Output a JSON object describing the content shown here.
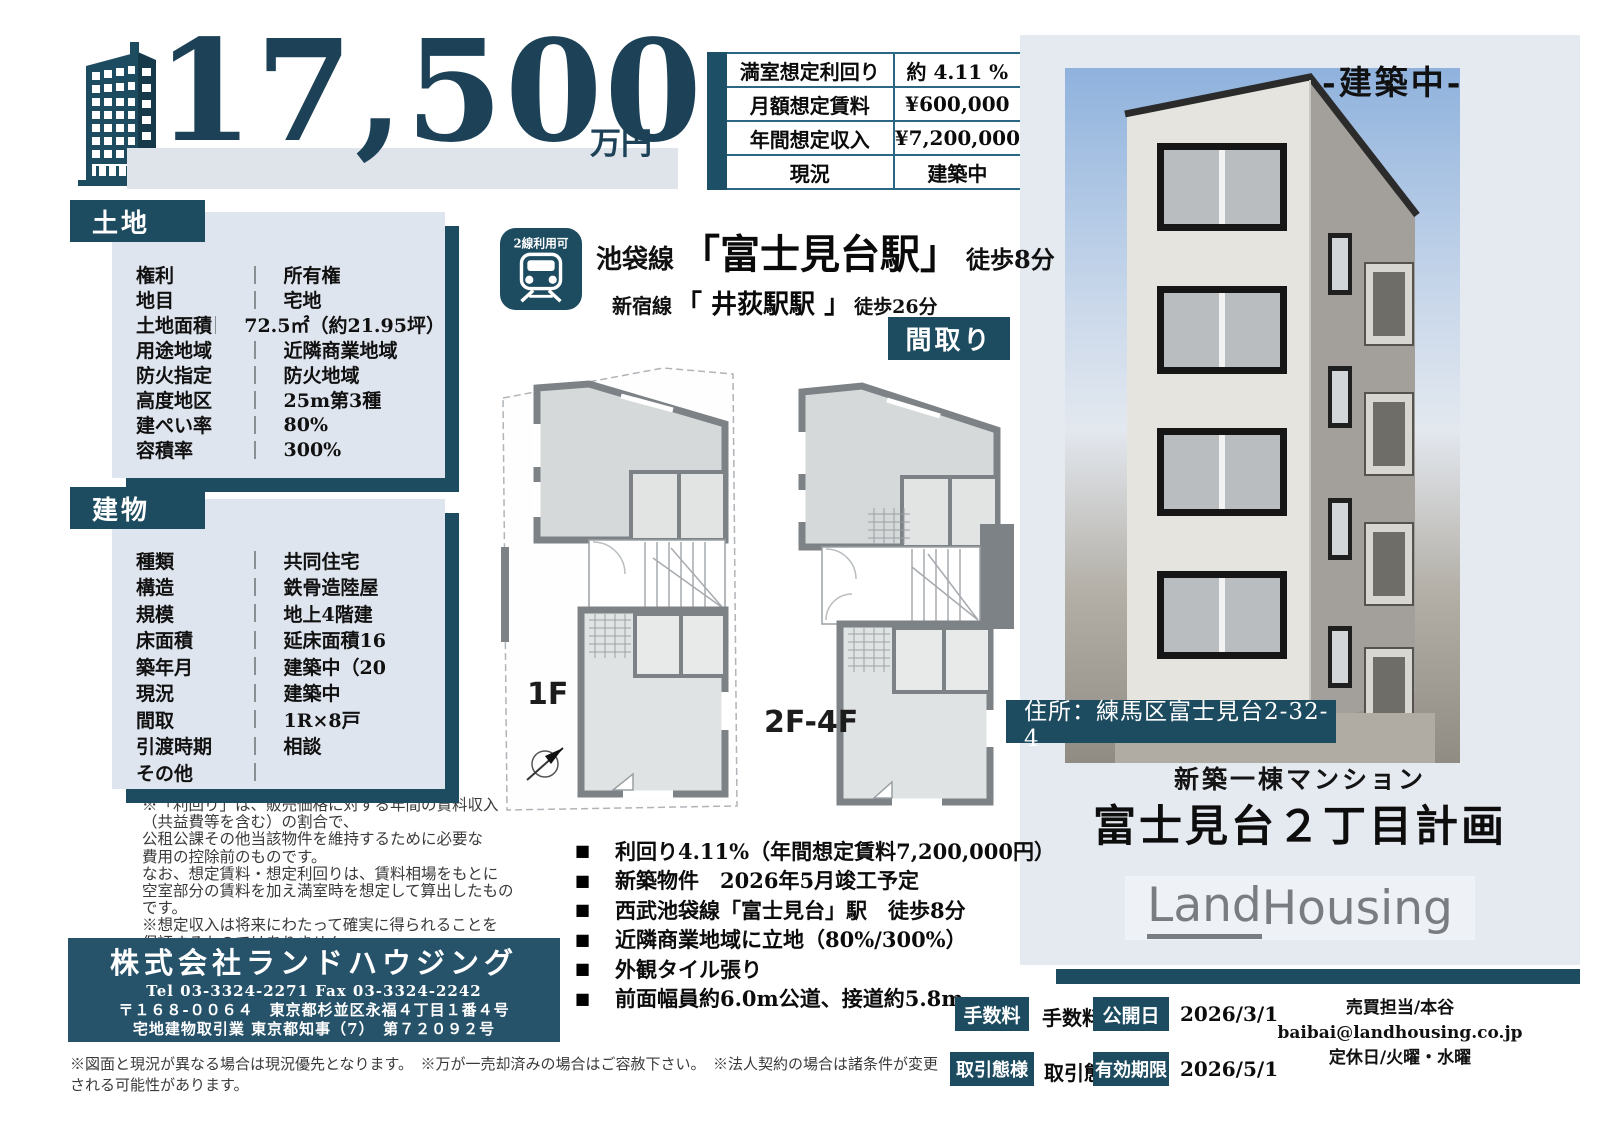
{
  "colors": {
    "teal": "#1d4b60",
    "teal_dark": "#16394a",
    "panel_blue": "#dfe5ee",
    "right_panel": "#e5e9f0",
    "price_text": "#1d4258"
  },
  "price": {
    "value": "17,500",
    "unit": "万円"
  },
  "summary": {
    "rows": [
      {
        "label": "満室想定利回り",
        "value": "約 4.11 %"
      },
      {
        "label": "月額想定賃料",
        "value": "¥600,000"
      },
      {
        "label": "年間想定収入",
        "value": "¥7,200,000"
      },
      {
        "label": "現況",
        "value": "建築中"
      }
    ]
  },
  "status_banner": "-建築中-",
  "access": {
    "badge": "2線利用可",
    "primary": {
      "line": "池袋線",
      "station": "「富士見台駅」",
      "walk": "徒歩8分"
    },
    "secondary": {
      "line": "新宿線",
      "station": "「 井荻駅駅 」",
      "walk": "徒歩26分"
    }
  },
  "floorplan": {
    "section_label": "間取り",
    "plan1": "1F",
    "plan2": "2F-4F"
  },
  "land": {
    "title": "土地",
    "rows": [
      {
        "label": "権利",
        "value": "所有権"
      },
      {
        "label": "地目",
        "value": "宅地"
      },
      {
        "label": "土地面積",
        "value": "72.5㎡（約21.95坪）"
      },
      {
        "label": "用途地域",
        "value": "近隣商業地域"
      },
      {
        "label": "防火指定",
        "value": "防火地域"
      },
      {
        "label": "高度地区",
        "value": "25m第3種"
      },
      {
        "label": "建ぺい率",
        "value": "80%"
      },
      {
        "label": "容積率",
        "value": "300%"
      }
    ]
  },
  "building": {
    "title": "建物",
    "rows": [
      {
        "label": "種類",
        "value": "共同住宅"
      },
      {
        "label": "構造",
        "value": "鉄骨造陸屋"
      },
      {
        "label": "規模",
        "value": "地上4階建"
      },
      {
        "label": "床面積",
        "value": "延床面積16"
      },
      {
        "label": "築年月",
        "value": "建築中（20"
      },
      {
        "label": "現況",
        "value": "建築中"
      },
      {
        "label": "間取",
        "value": "1R×8戸"
      },
      {
        "label": "引渡時期",
        "value": "相談"
      },
      {
        "label": "その他",
        "value": ""
      }
    ]
  },
  "disclaimer": {
    "lines": [
      "※「利回り」は、販売価格に対する年間の賃料収入",
      "（共益費等を含む）の割合で、",
      "公租公課その他当該物件を維持するために必要な",
      "費用の控除前のものです。",
      "なお、想定賃料・想定利回りは、賃料相場をもとに",
      "空室部分の賃料を加え満室時を想定して算出したものです。",
      "※想定収入は将来にわたって確実に得られることを",
      "保証するものではありません。"
    ]
  },
  "company": {
    "name": "株式会社ランドハウジング",
    "telfax": "Tel 03-3324-2271  Fax 03-3324-2242",
    "address": "〒１６８-００６４　東京都杉並区永福４丁目１番４号",
    "license": "宅地建物取引業 東京都知事（7）　第７２０９２号"
  },
  "footnote": "※図面と現況が異なる場合は現況優先となります。　※万が一売却済みの場合はご容赦下さい。　※法人契約の場合は諸条件が変更される可能性があります。",
  "property": {
    "address_label": "住所：練馬区富士見台2-32-4",
    "category": "新築一棟マンション",
    "title": "富士見台２丁目計画",
    "brand_l": "Land",
    "brand_h": "Housing"
  },
  "highlights": {
    "bullet": "■",
    "items": [
      "利回り4.11%（年間想定賃料7,200,000円）",
      "新築物件　2026年5月竣工予定",
      "西武池袋線「富士見台」駅　徒歩8分",
      "近隣商業地域に立地（80%/300%）",
      "外観タイル張り",
      "前面幅員約6.0m公道、接道約5.8m"
    ]
  },
  "deal": {
    "fee_label": "手数料",
    "fee_value": "手数料",
    "published_label": "公開日",
    "published_value": "2026/3/1",
    "mode_label": "取引態様",
    "mode_value": "取引態様",
    "valid_label": "有効期限",
    "valid_value": "2026/5/1",
    "contact_person": "売買担当/本谷",
    "contact_email": "baibai@landhousing.co.jp",
    "holiday": "定休日/火曜・水曜"
  }
}
